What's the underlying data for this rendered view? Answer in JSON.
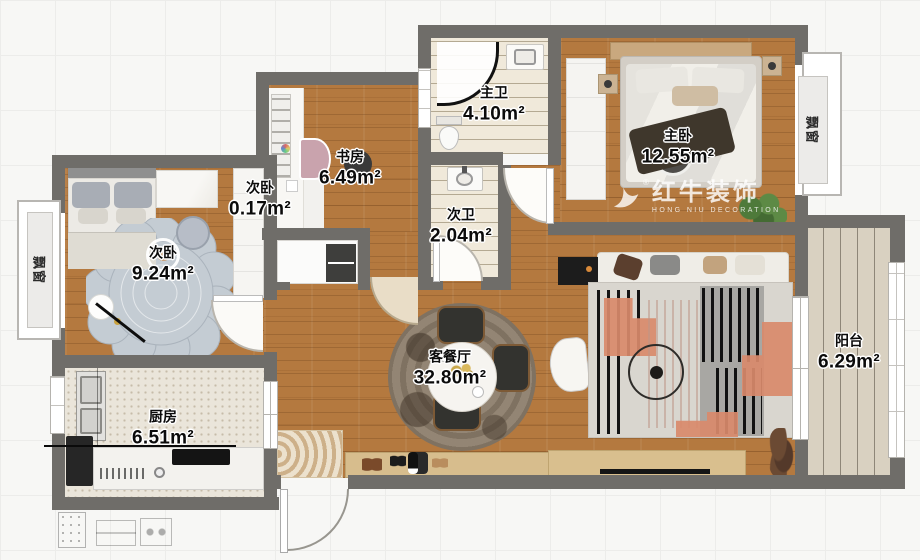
{
  "watermark": {
    "cn": "红牛装饰",
    "en": "HONG NIU DECORATION",
    "reg": "®"
  },
  "rooms": {
    "secondBedroom": {
      "name": "次卧",
      "area": "9.24m²"
    },
    "closet": {
      "name": "次卧",
      "area": "0.17m²"
    },
    "study": {
      "name": "书房",
      "area": "6.49m²"
    },
    "masterBath": {
      "name": "主卫",
      "area": "4.10m²"
    },
    "secondBath": {
      "name": "次卫",
      "area": "2.04m²"
    },
    "masterBedroom": {
      "name": "主卧",
      "area": "12.55m²"
    },
    "livingDining": {
      "name": "客餐厅",
      "area": "32.80m²"
    },
    "kitchen": {
      "name": "厨房",
      "area": "6.51m²"
    },
    "balcony": {
      "name": "阳台",
      "area": "6.29m²"
    }
  },
  "windows": {
    "leftBay": "飘窗",
    "rightBay": "飘窗"
  },
  "colors": {
    "wall": "#6f6d69",
    "woodFloor": "#b4793f",
    "accentSalmon": "#d98a6b",
    "rugGray": "#dcd8d0",
    "balconyFloor": "#d9d1c1",
    "kitchenFloor": "#eae5da",
    "bathFloor": "#f0e9da",
    "cabinetWood": "#d9bf8e"
  }
}
